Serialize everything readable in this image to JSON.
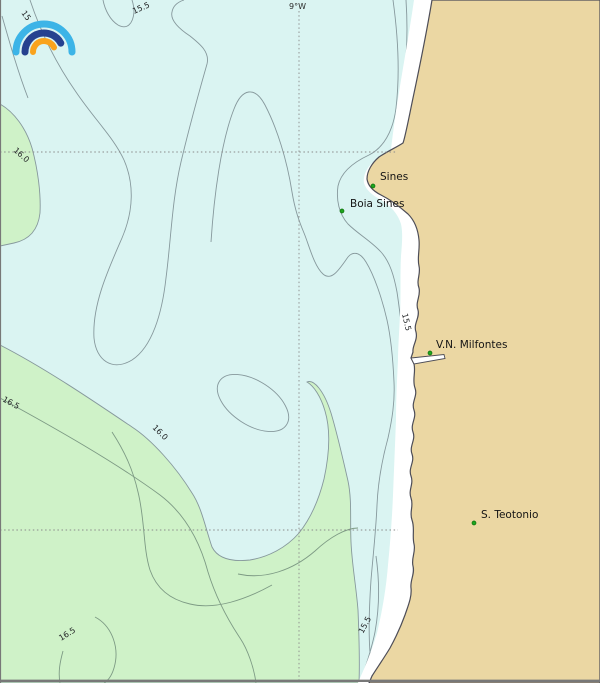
{
  "map": {
    "meridian_label": "9°W",
    "places": [
      {
        "name": "Sines"
      },
      {
        "name": "Boia Sines"
      },
      {
        "name": "V.N. Milfontes"
      },
      {
        "name": "S. Teotonio"
      }
    ],
    "contour_labels": [
      {
        "text": "15"
      },
      {
        "text": "15.5"
      },
      {
        "text": "16.0"
      },
      {
        "text": "16.5"
      },
      {
        "text": "16.0"
      },
      {
        "text": "15.5"
      },
      {
        "text": "16.5"
      },
      {
        "text": "15.5"
      }
    ],
    "colors": {
      "water": "#daf4f2",
      "land": "#ebd7a3",
      "warm_band": "#cff2c8",
      "cold_coastal_band": "#ffffff",
      "contour_line": "#86989c",
      "coastline": "#4d4d57",
      "grid_line": "#8a8a8a",
      "place_marker": "#1ea51e",
      "marker_edge": "#0c6e0c",
      "border": "#787878",
      "logo_arc_outer": "#3cb4e7",
      "logo_arc_middle": "#26418f",
      "logo_arc_inner": "#f9a31d"
    }
  }
}
